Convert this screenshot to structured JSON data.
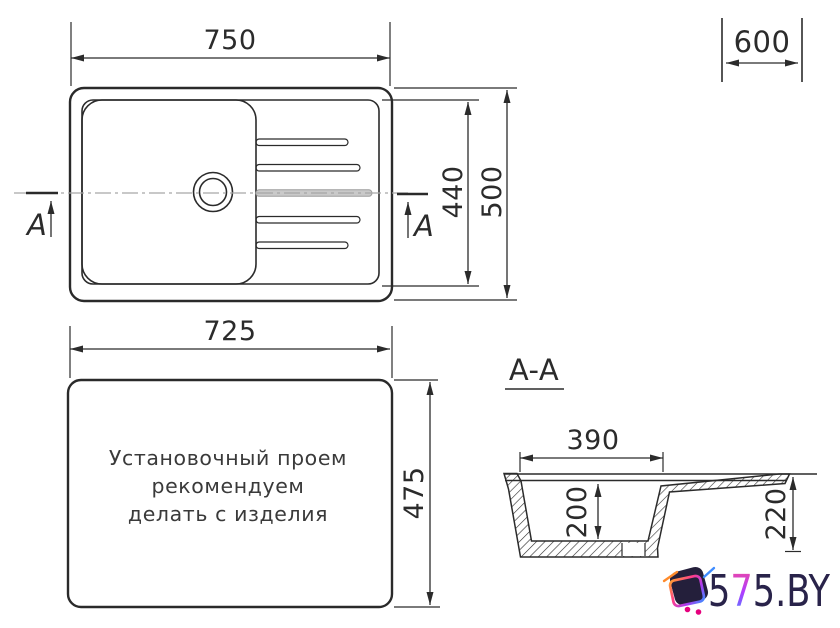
{
  "top_view": {
    "width": "750",
    "cabinet_width": "600",
    "bowl_height": "440",
    "depth": "500",
    "section_letter_left": "A",
    "section_letter_right": "A"
  },
  "cutout_view": {
    "width": "725",
    "height": "475",
    "note_line1": "Установочный проем",
    "note_line2": "рекомендуем",
    "note_line3": "делать с изделия"
  },
  "section_view": {
    "title": "A-A",
    "bowl_width": "390",
    "bowl_depth": "200",
    "overall_depth": "220"
  },
  "logo": {
    "part1": "5",
    "part2": "7",
    "part3": "5.BY"
  },
  "colors": {
    "line": "#2b2b2b",
    "centerline": "#a6a6a6",
    "logo_navy": "#241f3b",
    "logo_magenta": "#e5007d"
  }
}
